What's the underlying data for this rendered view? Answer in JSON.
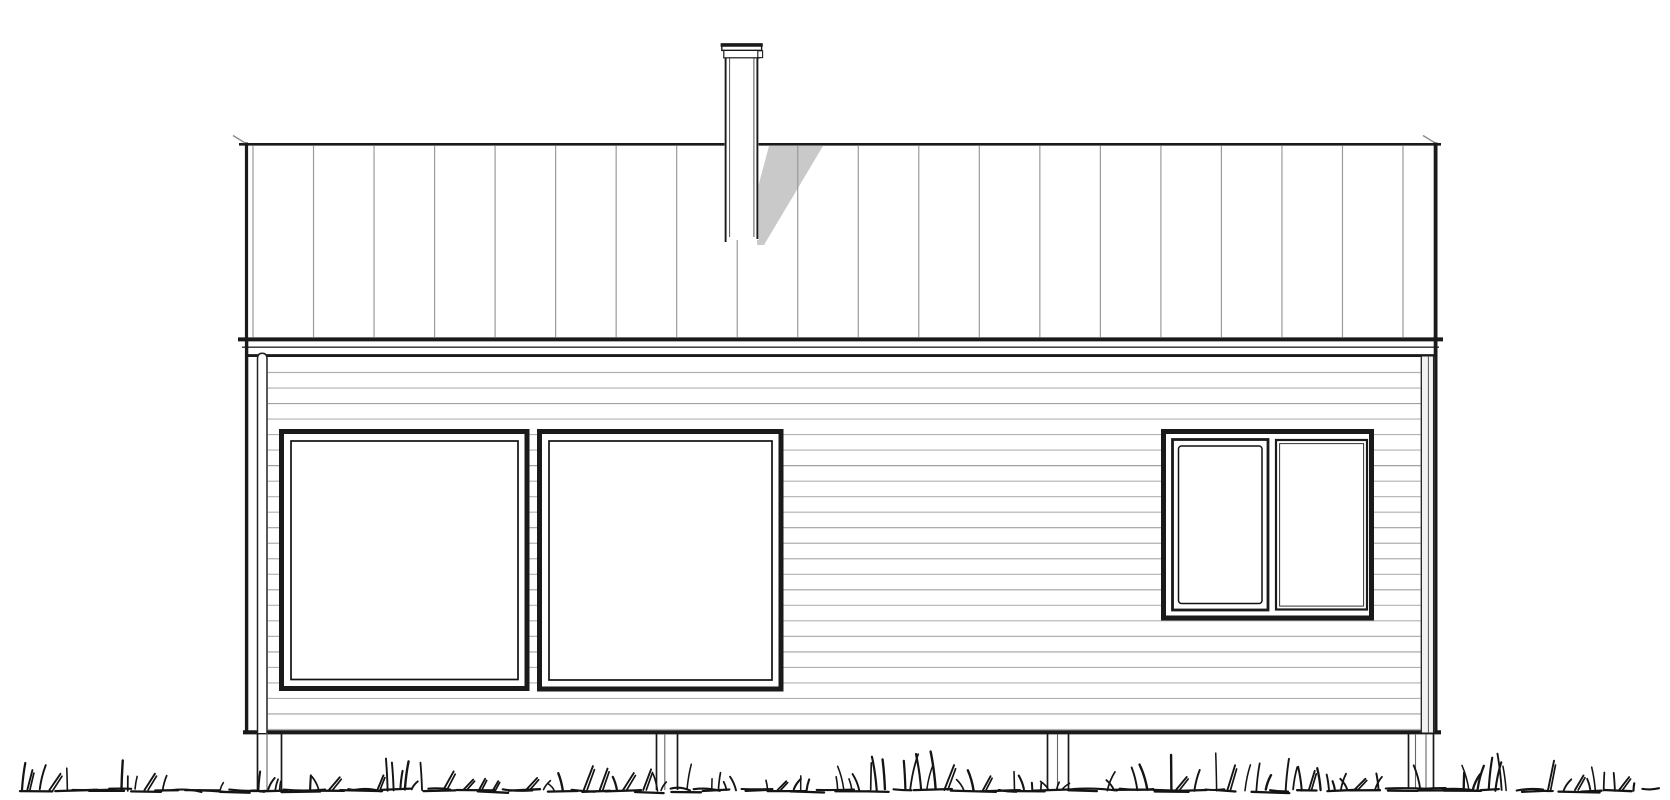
{
  "document": {
    "kind": "architectural-elevation-drawing",
    "subject": "single-storey house facade elevation"
  },
  "canvas": {
    "width": 1670,
    "height": 800,
    "background": "#ffffff"
  },
  "palette": {
    "ink": "#1a1a1a",
    "ridge_line": "#3c3c3c",
    "roof_seam": "#9a9a9a",
    "siding_line": "#b1b1b1",
    "shadow": "#c9c9c9",
    "corner_board_fill": "#f2f2f2",
    "grass": "#141414"
  },
  "roof": {
    "type": "standing-seam",
    "seam_count": 20
  },
  "chimney": {
    "count": 1,
    "has_cap": true,
    "casts_shadow": true
  },
  "siding": {
    "type": "horizontal-clapboard",
    "line_count": 24
  },
  "windows": {
    "large_left": {
      "panes": 1
    },
    "large_center": {
      "panes": 1
    },
    "right": {
      "panes": 2,
      "operable_sash": "left"
    }
  },
  "foundation": {
    "post_count": 4
  },
  "grass": {
    "seed": 11,
    "style": "scribbled-tufts"
  }
}
